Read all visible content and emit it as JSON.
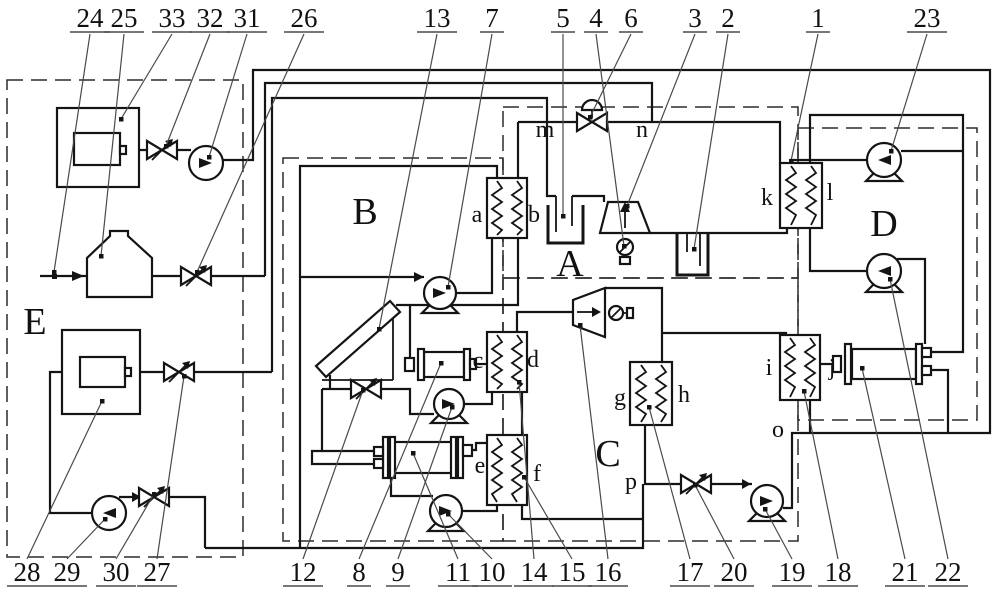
{
  "title": "multi-loop thermal system schematic",
  "colors": {
    "line": "#141414",
    "leader": "#4a4a4a",
    "background": "#ffffff"
  },
  "diagram": {
    "zone_letters": [
      {
        "text": "A",
        "x": 570,
        "y": 276
      },
      {
        "text": "B",
        "x": 365,
        "y": 224
      },
      {
        "text": "C",
        "x": 608,
        "y": 466
      },
      {
        "text": "D",
        "x": 884,
        "y": 236
      },
      {
        "text": "E",
        "x": 35,
        "y": 334
      }
    ],
    "node_letters": [
      {
        "text": "a",
        "x": 477,
        "y": 222
      },
      {
        "text": "b",
        "x": 534,
        "y": 222
      },
      {
        "text": "c",
        "x": 478,
        "y": 368
      },
      {
        "text": "d",
        "x": 533,
        "y": 367
      },
      {
        "text": "e",
        "x": 480,
        "y": 473
      },
      {
        "text": "f",
        "x": 537,
        "y": 481
      },
      {
        "text": "g",
        "x": 620,
        "y": 405
      },
      {
        "text": "h",
        "x": 684,
        "y": 402
      },
      {
        "text": "i",
        "x": 769,
        "y": 375
      },
      {
        "text": "j",
        "x": 832,
        "y": 375
      },
      {
        "text": "k",
        "x": 767,
        "y": 205
      },
      {
        "text": "l",
        "x": 830,
        "y": 200
      },
      {
        "text": "m",
        "x": 545,
        "y": 137
      },
      {
        "text": "n",
        "x": 642,
        "y": 137
      },
      {
        "text": "o",
        "x": 778,
        "y": 437
      },
      {
        "text": "p",
        "x": 631,
        "y": 489
      }
    ],
    "top_labels": [
      {
        "text": "24",
        "lx": 90,
        "tx": 54,
        "ty": 272
      },
      {
        "text": "25",
        "lx": 124,
        "tx": 101,
        "ty": 256
      },
      {
        "text": "33",
        "lx": 172,
        "tx": 121,
        "ty": 119
      },
      {
        "text": "32",
        "lx": 210,
        "tx": 166,
        "ty": 146
      },
      {
        "text": "31",
        "lx": 247,
        "tx": 209,
        "ty": 157
      },
      {
        "text": "26",
        "lx": 304,
        "tx": 197,
        "ty": 272
      },
      {
        "text": "13",
        "lx": 437,
        "tx": 379,
        "ty": 329
      },
      {
        "text": "7",
        "lx": 492,
        "tx": 448,
        "ty": 287
      },
      {
        "text": "5",
        "lx": 563,
        "tx": 563,
        "ty": 216
      },
      {
        "text": "4",
        "lx": 596,
        "tx": 624,
        "ty": 246
      },
      {
        "text": "6",
        "lx": 631,
        "tx": 590,
        "ty": 117
      },
      {
        "text": "3",
        "lx": 695,
        "tx": 627,
        "ty": 206
      },
      {
        "text": "2",
        "lx": 728,
        "tx": 694,
        "ty": 249
      },
      {
        "text": "1",
        "lx": 818,
        "tx": 791,
        "ty": 161
      },
      {
        "text": "23",
        "lx": 927,
        "tx": 891,
        "ty": 151
      }
    ],
    "bottom_labels": [
      {
        "text": "28",
        "lx": 27,
        "tx": 102,
        "ty": 401
      },
      {
        "text": "29",
        "lx": 67,
        "tx": 105,
        "ty": 519
      },
      {
        "text": "30",
        "lx": 116,
        "tx": 154,
        "ty": 494
      },
      {
        "text": "27",
        "lx": 157,
        "tx": 184,
        "ty": 376
      },
      {
        "text": "12",
        "lx": 303,
        "tx": 363,
        "ty": 390
      },
      {
        "text": "8",
        "lx": 359,
        "tx": 441,
        "ty": 363
      },
      {
        "text": "9",
        "lx": 398,
        "tx": 452,
        "ty": 407
      },
      {
        "text": "11",
        "lx": 458,
        "tx": 413,
        "ty": 453
      },
      {
        "text": "10",
        "lx": 492,
        "tx": 448,
        "ty": 514
      },
      {
        "text": "14",
        "lx": 534,
        "tx": 519,
        "ty": 382
      },
      {
        "text": "15",
        "lx": 572,
        "tx": 524,
        "ty": 477
      },
      {
        "text": "16",
        "lx": 608,
        "tx": 580,
        "ty": 325
      },
      {
        "text": "17",
        "lx": 690,
        "tx": 649,
        "ty": 407
      },
      {
        "text": "20",
        "lx": 734,
        "tx": 695,
        "ty": 485
      },
      {
        "text": "19",
        "lx": 792,
        "tx": 765,
        "ty": 509
      },
      {
        "text": "18",
        "lx": 838,
        "tx": 804,
        "ty": 391
      },
      {
        "text": "21",
        "lx": 905,
        "tx": 862,
        "ty": 368
      },
      {
        "text": "22",
        "lx": 948,
        "tx": 890,
        "ty": 279
      }
    ]
  }
}
